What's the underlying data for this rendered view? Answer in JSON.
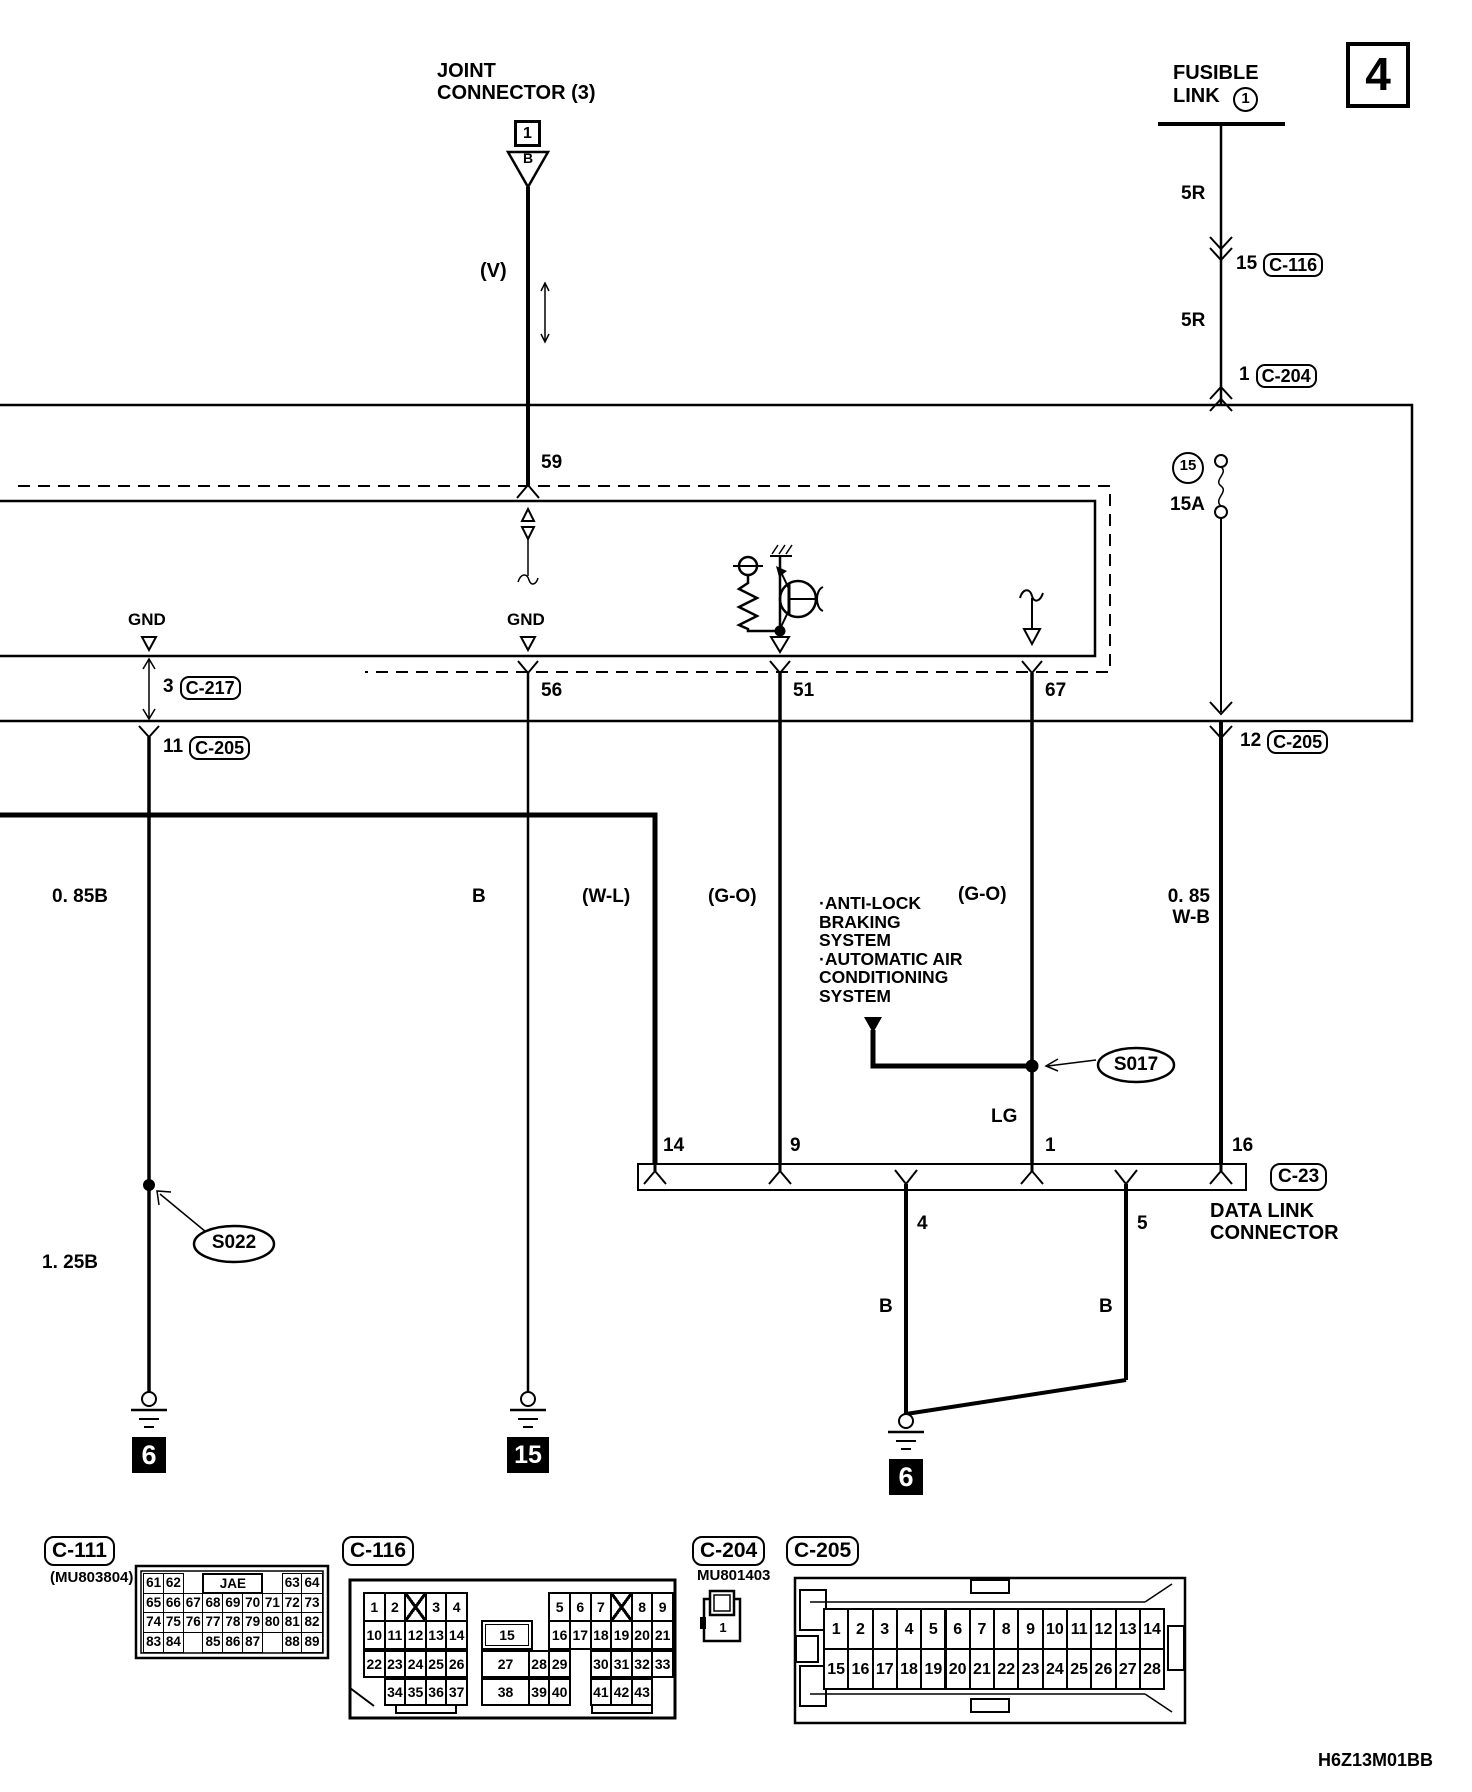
{
  "title_block": {
    "page_number": "4",
    "document_code": "H6Z13M01BB"
  },
  "joint_connector": {
    "name": "JOINT\nCONNECTOR (3)",
    "id_box": "1",
    "triangle_code": "B",
    "wire_color": "(V)",
    "pin": "59"
  },
  "fusible_link": {
    "name_line1": "FUSIBLE",
    "name_line2": "LINK",
    "number": "1",
    "wire_upper": "5R",
    "inline_pin": "15",
    "inline_connector": "C-116",
    "wire_lower": "5R",
    "junction_pin": "1",
    "junction_connector": "C-204"
  },
  "fuse": {
    "number": "15",
    "rating": "15A"
  },
  "ecu": {
    "gnd_left": "GND",
    "gnd_mid": "GND",
    "pin_gnd1": "3",
    "pin_gnd1_conn": "C-217",
    "pin_gnd2": "11",
    "pin_gnd2_conn": "C-205",
    "pin_56": "56",
    "pin_51": "51",
    "pin_67": "67",
    "pin_12": "12",
    "pin_12_conn": "C-205"
  },
  "wires": {
    "left_upper": "0. 85B",
    "left_lower": "1. 25B",
    "mid": "B",
    "wl": "(W-L)",
    "go1": "(G-O)",
    "go2": "(G-O)",
    "wb": "0. 85\nW-B",
    "lg": "LG",
    "dlc_b1": "B",
    "dlc_b2": "B"
  },
  "notes": {
    "abs": "·ANTI-LOCK\nBRAKING\nSYSTEM\n·AUTOMATIC AIR\nCONDITIONING\nSYSTEM"
  },
  "splices": {
    "s017": "S017",
    "s022": "S022"
  },
  "dlc": {
    "label": "C-23",
    "name": "DATA LINK\nCONNECTOR",
    "pin_14": "14",
    "pin_9": "9",
    "pin_1": "1",
    "pin_16": "16",
    "pin_4": "4",
    "pin_5": "5"
  },
  "grounds": {
    "left": "6",
    "mid": "15",
    "dlc": "6"
  },
  "connectors": {
    "c111": {
      "label": "C-111",
      "part": "(MU803804)",
      "rows": [
        [
          [
            "61",
            0
          ],
          [
            "62",
            1
          ],
          [
            "JAE",
            3,
            3
          ],
          [
            "63",
            7
          ],
          [
            "64",
            8
          ]
        ],
        [
          [
            "65",
            0
          ],
          [
            "66",
            1
          ],
          [
            "67",
            2
          ],
          [
            "68",
            3
          ],
          [
            "69",
            4
          ],
          [
            "70",
            5
          ],
          [
            "71",
            6
          ],
          [
            "72",
            7
          ],
          [
            "73",
            8
          ]
        ],
        [
          [
            "74",
            0
          ],
          [
            "75",
            1
          ],
          [
            "76",
            2
          ],
          [
            "77",
            3
          ],
          [
            "78",
            4
          ],
          [
            "79",
            5
          ],
          [
            "80",
            6
          ],
          [
            "81",
            7
          ],
          [
            "82",
            8
          ]
        ],
        [
          [
            "83",
            0
          ],
          [
            "84",
            1
          ],
          [
            "85",
            3
          ],
          [
            "86",
            4
          ],
          [
            "87",
            5
          ],
          [
            "88",
            7
          ],
          [
            "89",
            8
          ]
        ]
      ]
    },
    "c116": {
      "label": "C-116",
      "rows": [
        [
          [
            "1",
            0
          ],
          [
            "2",
            1
          ],
          [
            "",
            2,
            "x"
          ],
          [
            "3",
            3
          ],
          [
            "4",
            4
          ],
          [
            "5",
            9
          ],
          [
            "6",
            10
          ],
          [
            "7",
            11
          ],
          [
            "",
            12,
            "x"
          ],
          [
            "8",
            13
          ],
          [
            "9",
            14
          ]
        ],
        [
          [
            "10",
            0
          ],
          [
            "11",
            1
          ],
          [
            "12",
            2
          ],
          [
            "13",
            3
          ],
          [
            "14",
            4
          ],
          [
            "15",
            5,
            "boxed"
          ],
          [
            "16",
            9
          ],
          [
            "17",
            10
          ],
          [
            "18",
            11
          ],
          [
            "19",
            12
          ],
          [
            "20",
            13
          ],
          [
            "21",
            14
          ]
        ],
        [
          [
            "22",
            0
          ],
          [
            "23",
            1
          ],
          [
            "24",
            2
          ],
          [
            "25",
            3
          ],
          [
            "26",
            4
          ],
          [
            "27",
            5,
            "wide"
          ],
          [
            "28",
            8
          ],
          [
            "29",
            9
          ],
          [
            "30",
            11
          ],
          [
            "31",
            12
          ],
          [
            "32",
            13
          ],
          [
            "33",
            14
          ]
        ],
        [
          [
            "34",
            1
          ],
          [
            "35",
            2
          ],
          [
            "36",
            3
          ],
          [
            "37",
            4
          ],
          [
            "38",
            5,
            "wide"
          ],
          [
            "39",
            8
          ],
          [
            "40",
            9
          ],
          [
            "41",
            11
          ],
          [
            "42",
            12
          ],
          [
            "43",
            13
          ]
        ]
      ]
    },
    "c204": {
      "label": "C-204",
      "part": "MU801403",
      "pin": "1"
    },
    "c205": {
      "label": "C-205",
      "row1": [
        "1",
        "2",
        "3",
        "4",
        "5",
        "6",
        "7",
        "8",
        "9",
        "10",
        "11",
        "12",
        "13",
        "14"
      ],
      "row2": [
        "15",
        "16",
        "17",
        "18",
        "19",
        "20",
        "21",
        "22",
        "23",
        "24",
        "25",
        "26",
        "27",
        "28"
      ]
    }
  }
}
